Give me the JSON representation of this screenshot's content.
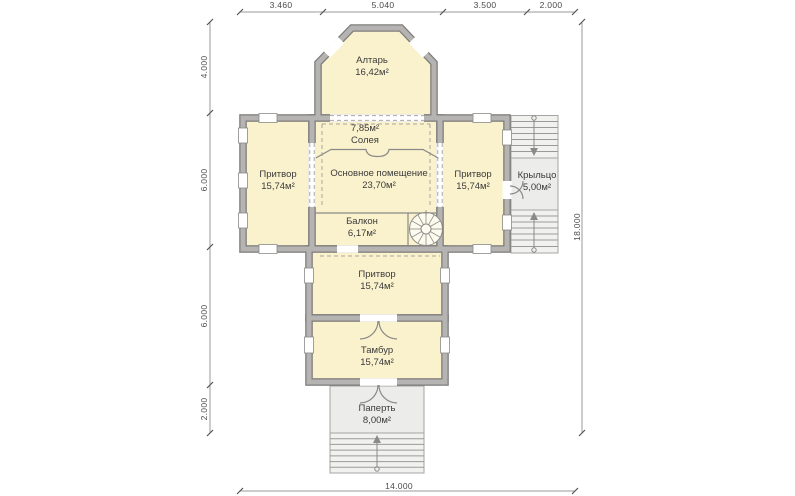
{
  "plan": {
    "rooms": {
      "altar": {
        "name": "Алтарь",
        "area": "16,42м²"
      },
      "soleya": {
        "name": "Солея",
        "area": "7,85м²"
      },
      "narthex_left": {
        "name": "Притвор",
        "area": "15,74м²"
      },
      "main_hall": {
        "name": "Основное помещение",
        "area": "23,70м²"
      },
      "narthex_right": {
        "name": "Притвор",
        "area": "15,74м²"
      },
      "porch_right": {
        "name": "Крыльцо",
        "area": "5,00м²"
      },
      "balcony": {
        "name": "Балкон",
        "area": "6,17м²"
      },
      "narthex_south": {
        "name": "Притвор",
        "area": "15,74м²"
      },
      "tambour": {
        "name": "Тамбур",
        "area": "15,74м²"
      },
      "papert": {
        "name": "Паперть",
        "area": "8,00м²"
      }
    },
    "dimensions": {
      "top": {
        "d1": "3.460",
        "d2": "5.040",
        "d3": "3.500",
        "d4": "2.000"
      },
      "left": {
        "d1": "4.000",
        "d2": "6.000",
        "d3": "6.000",
        "d4": "2.000"
      },
      "right": {
        "total": "18.000"
      },
      "bottom": {
        "total": "14.000"
      }
    },
    "colors": {
      "room_fill": "#faf1cd",
      "wall": "#b5b4b2",
      "wall_edge": "#7f7e7c",
      "porch_fill": "#ececea"
    }
  }
}
